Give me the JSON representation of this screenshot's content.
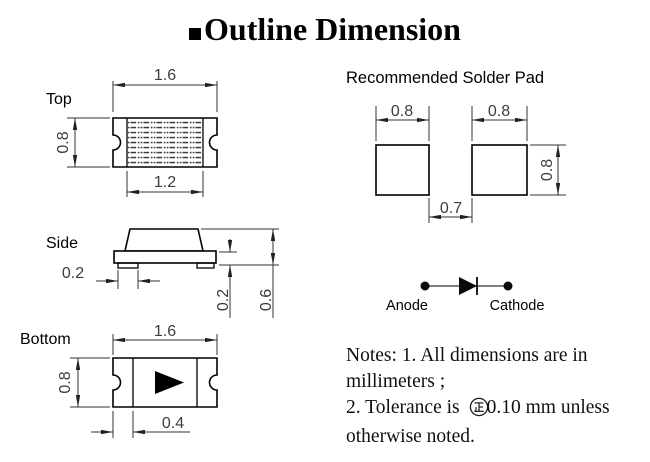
{
  "title": {
    "text": "Outline Dimension"
  },
  "views": {
    "top": {
      "label": "Top",
      "dim_width": "1.6",
      "dim_height": "0.8",
      "dim_inner_width": "1.2"
    },
    "side": {
      "label": "Side",
      "dim_terminal": "0.2",
      "dim_base_thickness": "0.2",
      "dim_total_height": "0.6"
    },
    "bottom": {
      "label": "Bottom",
      "dim_width": "1.6",
      "dim_height": "0.8",
      "dim_terminal_width": "0.4"
    }
  },
  "solder_pad": {
    "title": "Recommended Solder Pad",
    "dim_left_width": "0.8",
    "dim_right_width": "0.8",
    "dim_height": "0.8",
    "dim_gap": "0.7"
  },
  "polarity": {
    "anode": "Anode",
    "cathode": "Cathode"
  },
  "notes": {
    "line1": "Notes: 1. All dimensions are in",
    "line2": "millimeters ;",
    "line3_before": "2. Tolerance is",
    "line3_after": "0.10 mm unless",
    "line4": "otherwise noted."
  },
  "colors": {
    "ink": "#000000",
    "dim_line": "#333333",
    "dim_text": "#3d3d3d"
  }
}
